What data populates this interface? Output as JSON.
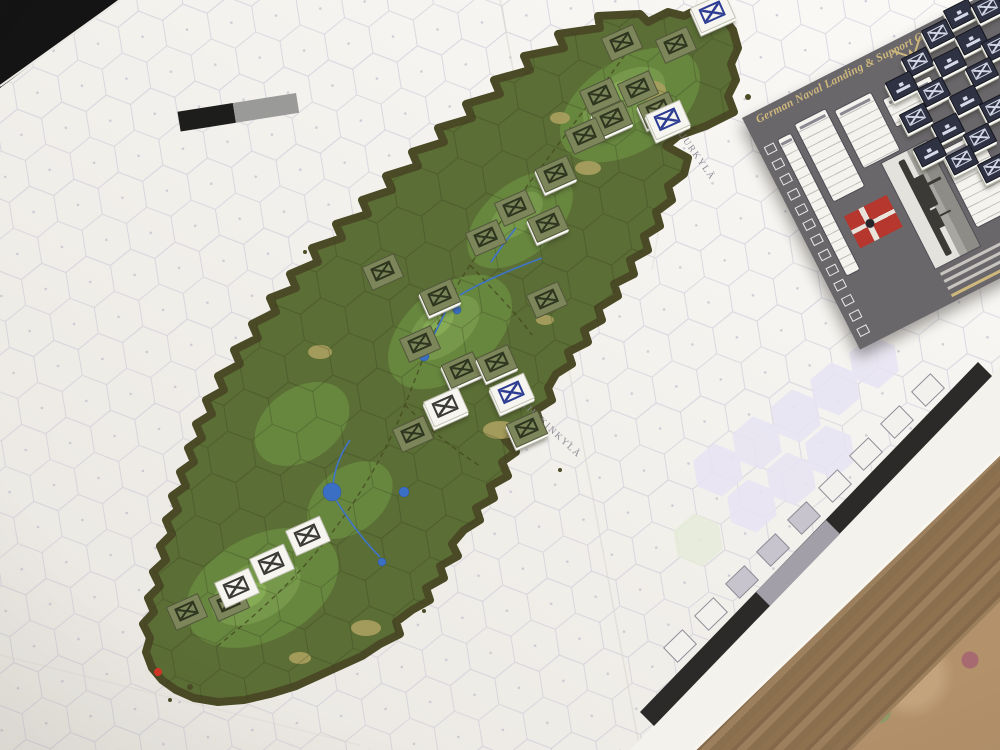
{
  "map": {
    "labels": [
      {
        "id": "suurkyla",
        "text": "SUURKYLÄ"
      },
      {
        "id": "kiiskinkyla",
        "text": "KIISKINKYLÄ"
      }
    ],
    "edge_track_boxes": 9,
    "marker_red_dot_color": "#d23424"
  },
  "chart": {
    "title": "German Naval Landing & Support Chart for Suursaari 1944 Scenario",
    "track_squares": 13,
    "accent_gold": "#cfb87c",
    "background": "#6a676b",
    "flag_red": "#b5372e"
  },
  "counters": {
    "green": [
      [
        622,
        43,
        2
      ],
      [
        676,
        45,
        2
      ],
      [
        600,
        96,
        2
      ],
      [
        638,
        89,
        2
      ],
      [
        612,
        119,
        1
      ],
      [
        585,
        136,
        2
      ],
      [
        658,
        110,
        1
      ],
      [
        556,
        174,
        1
      ],
      [
        515,
        208,
        2
      ],
      [
        548,
        224,
        1
      ],
      [
        486,
        238,
        2
      ],
      [
        383,
        272,
        2
      ],
      [
        440,
        297,
        1
      ],
      [
        547,
        300,
        2
      ],
      [
        420,
        344,
        2
      ],
      [
        462,
        370,
        1
      ],
      [
        497,
        363,
        1
      ],
      [
        413,
        434,
        2
      ],
      [
        527,
        429,
        1
      ],
      [
        187,
        612,
        2
      ],
      [
        229,
        603,
        2
      ]
    ],
    "white": [
      [
        713,
        13,
        1,
        "blue"
      ],
      [
        668,
        120,
        1,
        "blue"
      ],
      [
        512,
        393,
        1,
        "blue"
      ],
      [
        446,
        407,
        1,
        "dark"
      ],
      [
        308,
        536,
        2,
        "dark"
      ],
      [
        272,
        564,
        2,
        "dark"
      ],
      [
        237,
        588,
        2,
        "dark"
      ]
    ],
    "navy": [
      [
        960,
        14,
        "ship"
      ],
      [
        988,
        8,
        "x"
      ],
      [
        938,
        34,
        "x"
      ],
      [
        972,
        40,
        "ship"
      ],
      [
        998,
        46,
        "x"
      ],
      [
        918,
        62,
        "x"
      ],
      [
        950,
        62,
        "ship"
      ],
      [
        982,
        72,
        "x"
      ],
      [
        902,
        86,
        "ship"
      ],
      [
        934,
        92,
        "x"
      ],
      [
        966,
        100,
        "ship"
      ],
      [
        996,
        108,
        "x"
      ],
      [
        916,
        118,
        "x"
      ],
      [
        948,
        128,
        "ship"
      ],
      [
        980,
        138,
        "x"
      ],
      [
        930,
        152,
        "ship"
      ],
      [
        962,
        160,
        "x"
      ],
      [
        994,
        168,
        "x"
      ]
    ]
  },
  "colors": {
    "sheet": "#f3f2ed",
    "hex_line": "#c9c5d6",
    "island_coast": "#4a4a26",
    "island_base": "#5b6e35",
    "contour_1": "#67863e",
    "contour_2": "#76984a",
    "contour_3": "#85ab55",
    "clearing": "#aba05f",
    "water": "#3a6fc4",
    "counter_green": "#7d855a",
    "counter_white": "#f6f5ef",
    "counter_navy": "#2f3242",
    "wood": "#8a6f4e",
    "carpet": "#b3916a"
  }
}
